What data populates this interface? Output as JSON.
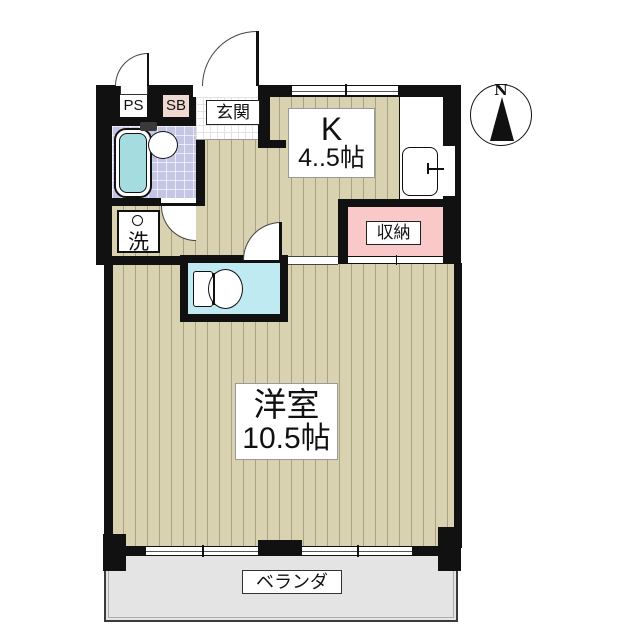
{
  "floorplan": {
    "compass": {
      "north": "N"
    },
    "rooms": {
      "ps": {
        "label": "PS"
      },
      "sb": {
        "label": "SB"
      },
      "entrance": {
        "label": "玄関"
      },
      "kitchen": {
        "line1": "K",
        "line2": "4..5帖"
      },
      "storage": {
        "label": "収納"
      },
      "laundry": {
        "label": "洗"
      },
      "western": {
        "line1": "洋室",
        "line2": "10.5帖"
      },
      "veranda": {
        "label": "ベランダ"
      }
    },
    "colors": {
      "floor_tan": "#d8d2b0",
      "floor_stripe": "#a8a284",
      "bath_tile": "#c5c5e5",
      "bathtub": "#a5dce0",
      "toilet_room": "#bfeaf2",
      "storage_pink": "#f9c9c9",
      "sb_pink": "#eed8d2",
      "veranda_gray": "#e4e4e4",
      "wall": "#111111"
    }
  }
}
